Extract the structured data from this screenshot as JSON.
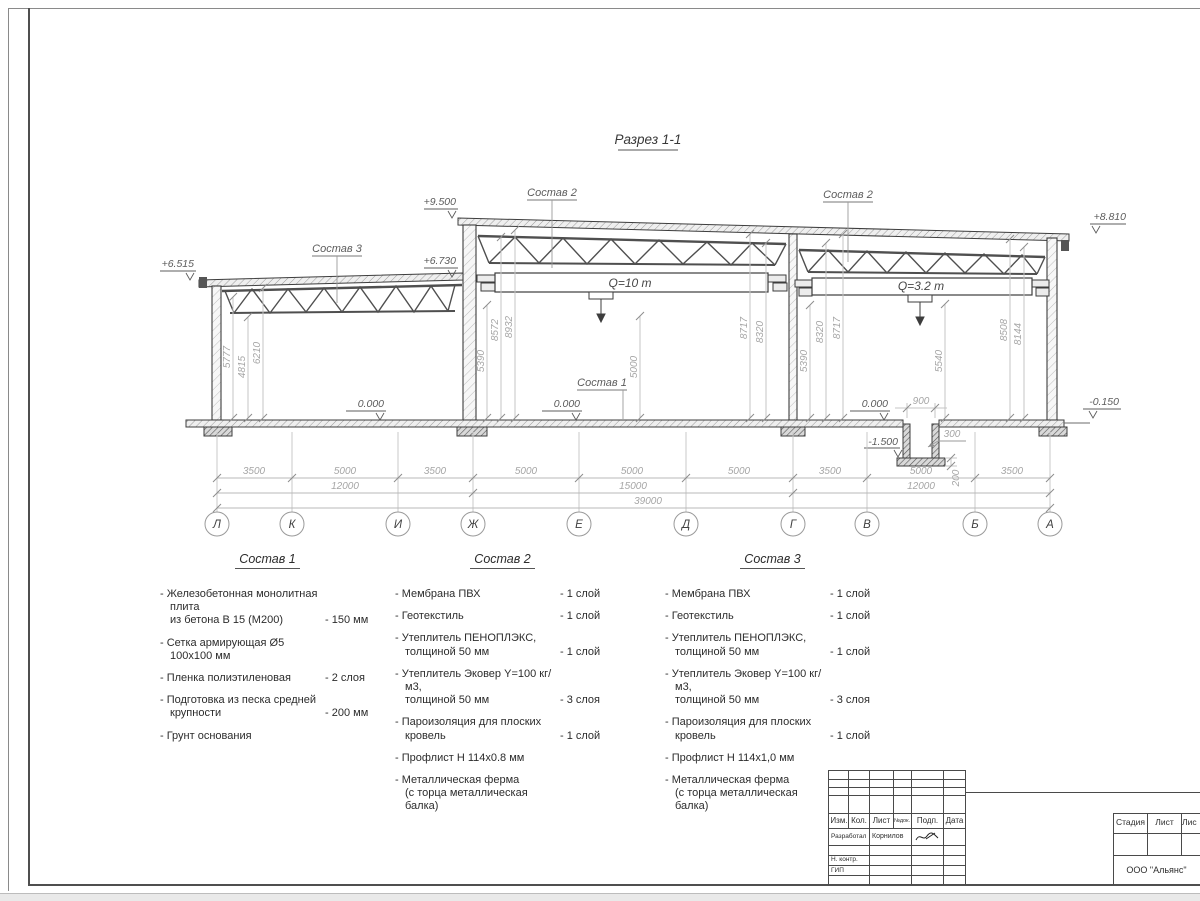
{
  "sheet": {
    "section_title": "Разрез 1-1"
  },
  "drawing": {
    "elevations": {
      "low_left": "+6.515",
      "high_left": "+9.500",
      "low_right": "+6.730",
      "high_right": "+8.810",
      "zero_1": "0.000",
      "zero_2": "0.000",
      "zero_3": "0.000",
      "ground": "-0.150",
      "pit": "-1.500"
    },
    "labels": {
      "sostav_1": "Состав 1",
      "sostav_2_left": "Состав 2",
      "sostav_2_right": "Состав 2",
      "sostav_3": "Состав 3",
      "crane_main": "Q=10 т",
      "crane_aux": "Q=3.2 т"
    },
    "vdims": [
      "5777",
      "4815",
      "6210",
      "5390",
      "8572",
      "8932",
      "5000",
      "8717",
      "8320",
      "5390",
      "8320",
      "8717",
      "5540",
      "8508",
      "8144"
    ],
    "pit_dims": {
      "width": "900",
      "wall": "300",
      "slab": "200"
    },
    "dims_row1": [
      "3500",
      "5000",
      "3500",
      "5000",
      "5000",
      "5000",
      "3500",
      "5000",
      "3500"
    ],
    "dims_row2": [
      "12000",
      "15000",
      "12000"
    ],
    "dims_total": "39000",
    "axes": [
      "Л",
      "К",
      "И",
      "Ж",
      "Е",
      "Д",
      "Г",
      "В",
      "Б",
      "А"
    ]
  },
  "compositions": [
    {
      "title": "Состав 1",
      "items": [
        {
          "name": "- Железобетонная  монолитная плита\nиз бетона В 15 (М200)",
          "value": "- 150 мм"
        },
        {
          "name": "- Сетка армирующая Ø5 100х100 мм",
          "value": ""
        },
        {
          "name": "- Пленка полиэтиленовая",
          "value": "- 2 слоя"
        },
        {
          "name": "- Подготовка из песка средней\nкрупности",
          "value": "- 200 мм"
        },
        {
          "name": "- Грунт основания",
          "value": ""
        }
      ]
    },
    {
      "title": "Состав 2",
      "items": [
        {
          "name": "- Мембрана ПВХ",
          "value": "- 1 слой"
        },
        {
          "name": "- Геотекстиль",
          "value": "- 1 слой"
        },
        {
          "name": "- Утеплитель ПЕНОПЛЭКС,\nтолщиной 50 мм",
          "value": "- 1 слой"
        },
        {
          "name": "- Утеплитель Эковер Y=100 кг/м3,\nтолщиной 50 мм",
          "value": "- 3 слоя"
        },
        {
          "name": "- Пароизоляция для плоских кровель",
          "value": "- 1 слой"
        },
        {
          "name": "- Профлист Н 114х0.8 мм",
          "value": ""
        },
        {
          "name": "- Металлическая ферма\n(с торца металлическая балка)",
          "value": ""
        }
      ]
    },
    {
      "title": "Состав 3",
      "items": [
        {
          "name": "- Мембрана ПВХ",
          "value": "- 1 слой"
        },
        {
          "name": "- Геотекстиль",
          "value": "- 1 слой"
        },
        {
          "name": "- Утеплитель ПЕНОПЛЭКС,\nтолщиной 50 мм",
          "value": "- 1 слой"
        },
        {
          "name": "- Утеплитель Эковер Y=100 кг/м3,\nтолщиной 50 мм",
          "value": "- 3 слоя"
        },
        {
          "name": "- Пароизоляция для плоских кровель",
          "value": "- 1 слой"
        },
        {
          "name": "- Профлист Н 114х1,0 мм",
          "value": ""
        },
        {
          "name": "- Металлическая ферма\n(с торца металлическая балка)",
          "value": ""
        }
      ]
    }
  ],
  "titleblock": {
    "cols": [
      "Изм.",
      "Кол.",
      "Лист",
      "№док.",
      "Подп.",
      "Дата"
    ],
    "rows": [
      {
        "role": "Разработал",
        "name": "Корнилов"
      },
      {
        "role": "Н. контр.",
        "name": ""
      },
      {
        "role": "ГИП",
        "name": ""
      }
    ],
    "stage_cols": [
      "Стадия",
      "Лист",
      "Лис"
    ],
    "company": "ООО \"Альянс\""
  }
}
